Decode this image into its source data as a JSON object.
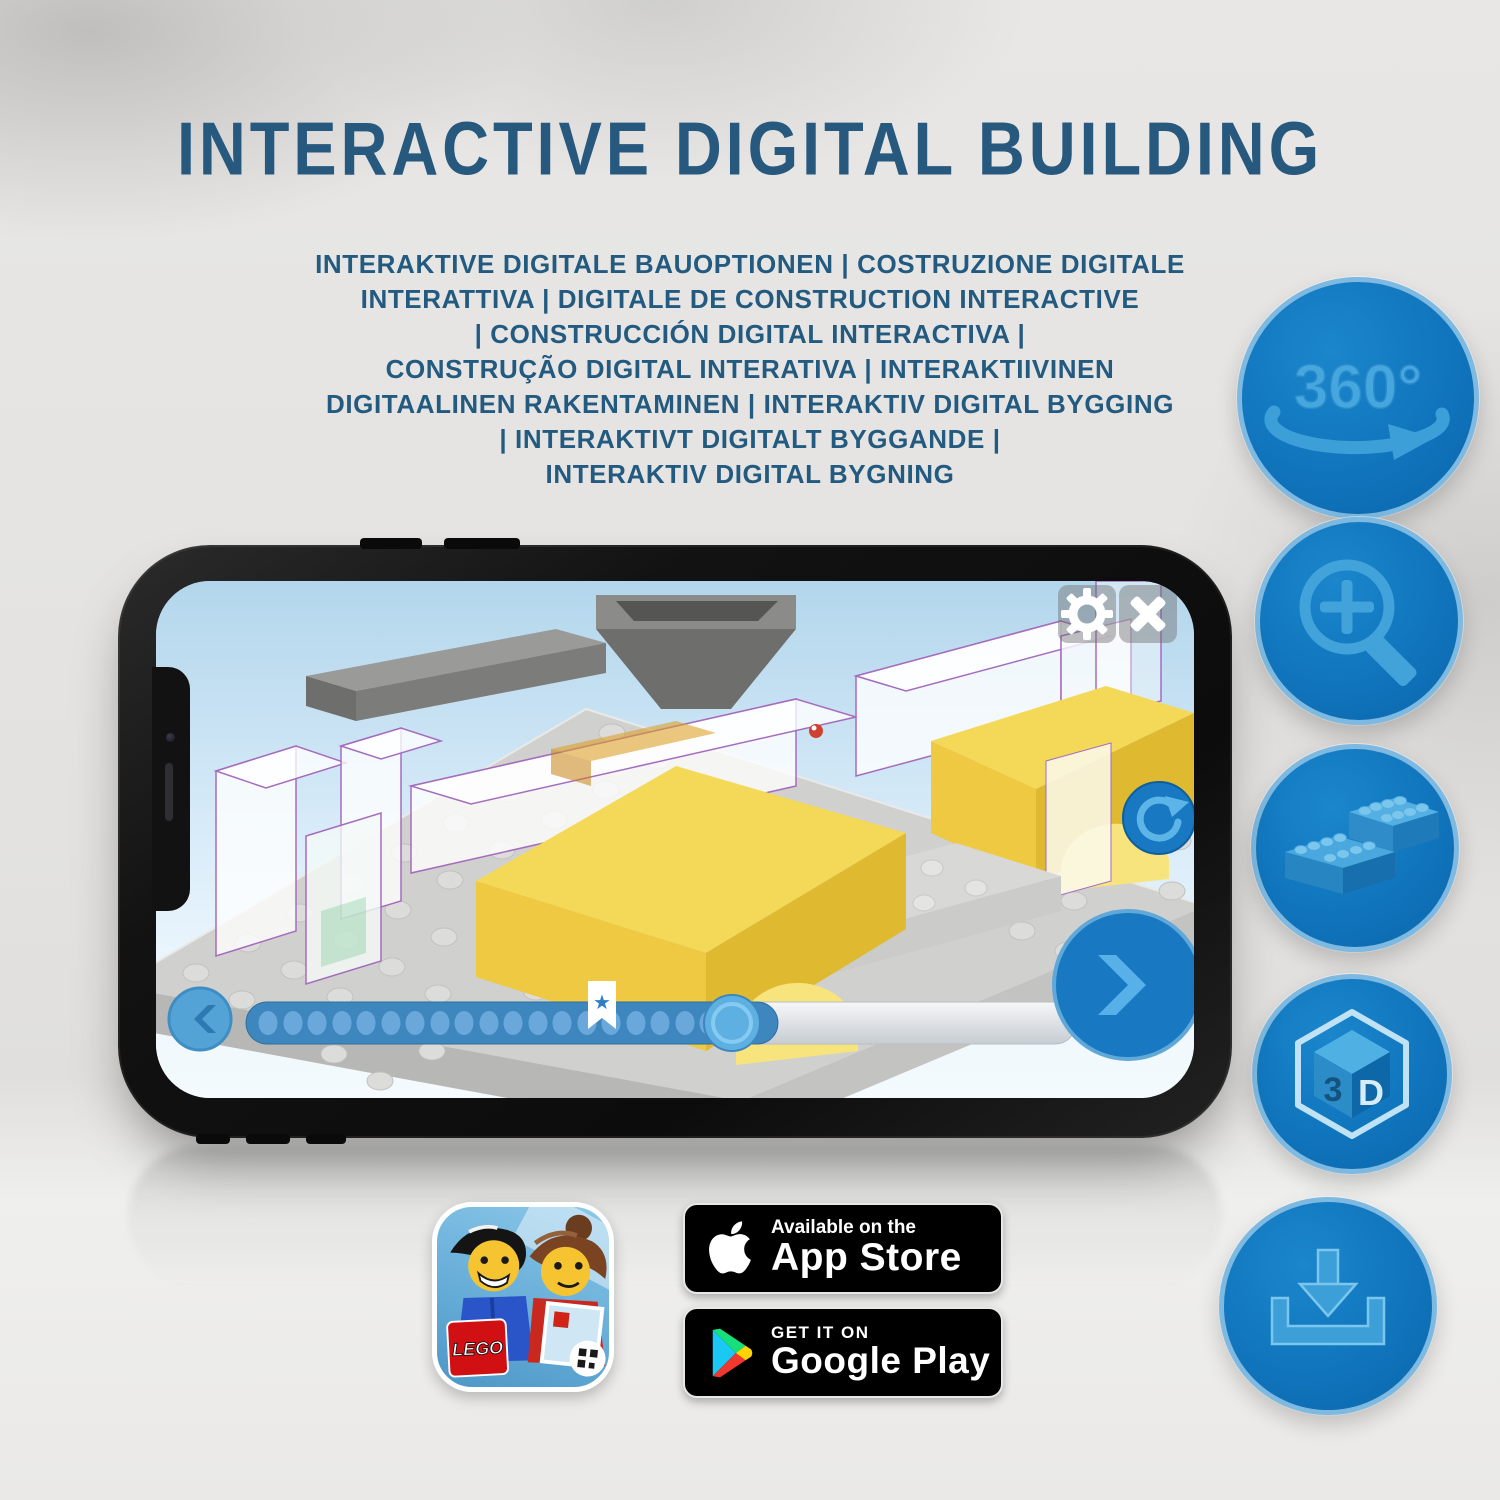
{
  "title": {
    "text": "INTERACTIVE DIGITAL BUILDING"
  },
  "subtitle": {
    "lines": [
      "INTERAKTIVE DIGITALE BAUOPTIONEN | COSTRUZIONE DIGITALE",
      "INTERATTIVA | DIGITALE DE CONSTRUCTION INTERACTIVE",
      "| CONSTRUCCIÓN DIGITAL INTERACTIVA |",
      "CONSTRUÇÃO DIGITAL INTERATIVA | INTERAKTIIVINEN",
      "DIGITAALINEN RAKENTAMINEN | INTERAKTIV DIGITAL BYGGING",
      "| INTERAKTIVT DIGITALT BYGGANDE |",
      "INTERAKTIV DIGITAL BYGNING"
    ]
  },
  "features": [
    {
      "name": "360-rotation",
      "label": "360°"
    },
    {
      "name": "zoom-in"
    },
    {
      "name": "brick-building"
    },
    {
      "name": "3d-view",
      "label_left": "3",
      "label_right": "D"
    },
    {
      "name": "download"
    }
  ],
  "phone": {
    "app_ui": {
      "progress_percent": 64,
      "step_dots": 19,
      "bookmark_star": "★",
      "buttons": [
        "settings",
        "close",
        "refresh",
        "previous-step",
        "next-step"
      ]
    }
  },
  "badges": {
    "lego_app": {
      "logo_text": "LEGO"
    },
    "app_store": {
      "line1": "Available on the",
      "line2": "App Store"
    },
    "google_play": {
      "line1": "GET IT ON",
      "line2": "Google Play"
    }
  },
  "colors": {
    "heading_blue": "#27587e",
    "circle_fill": "#1075bd",
    "circle_ring": "#7db9e0",
    "icon_glyph": "#41a3da",
    "app_button_blue": "#1878c2",
    "progress_track_blue": "#3d86be",
    "highlight_yellow": "#f4d858"
  }
}
